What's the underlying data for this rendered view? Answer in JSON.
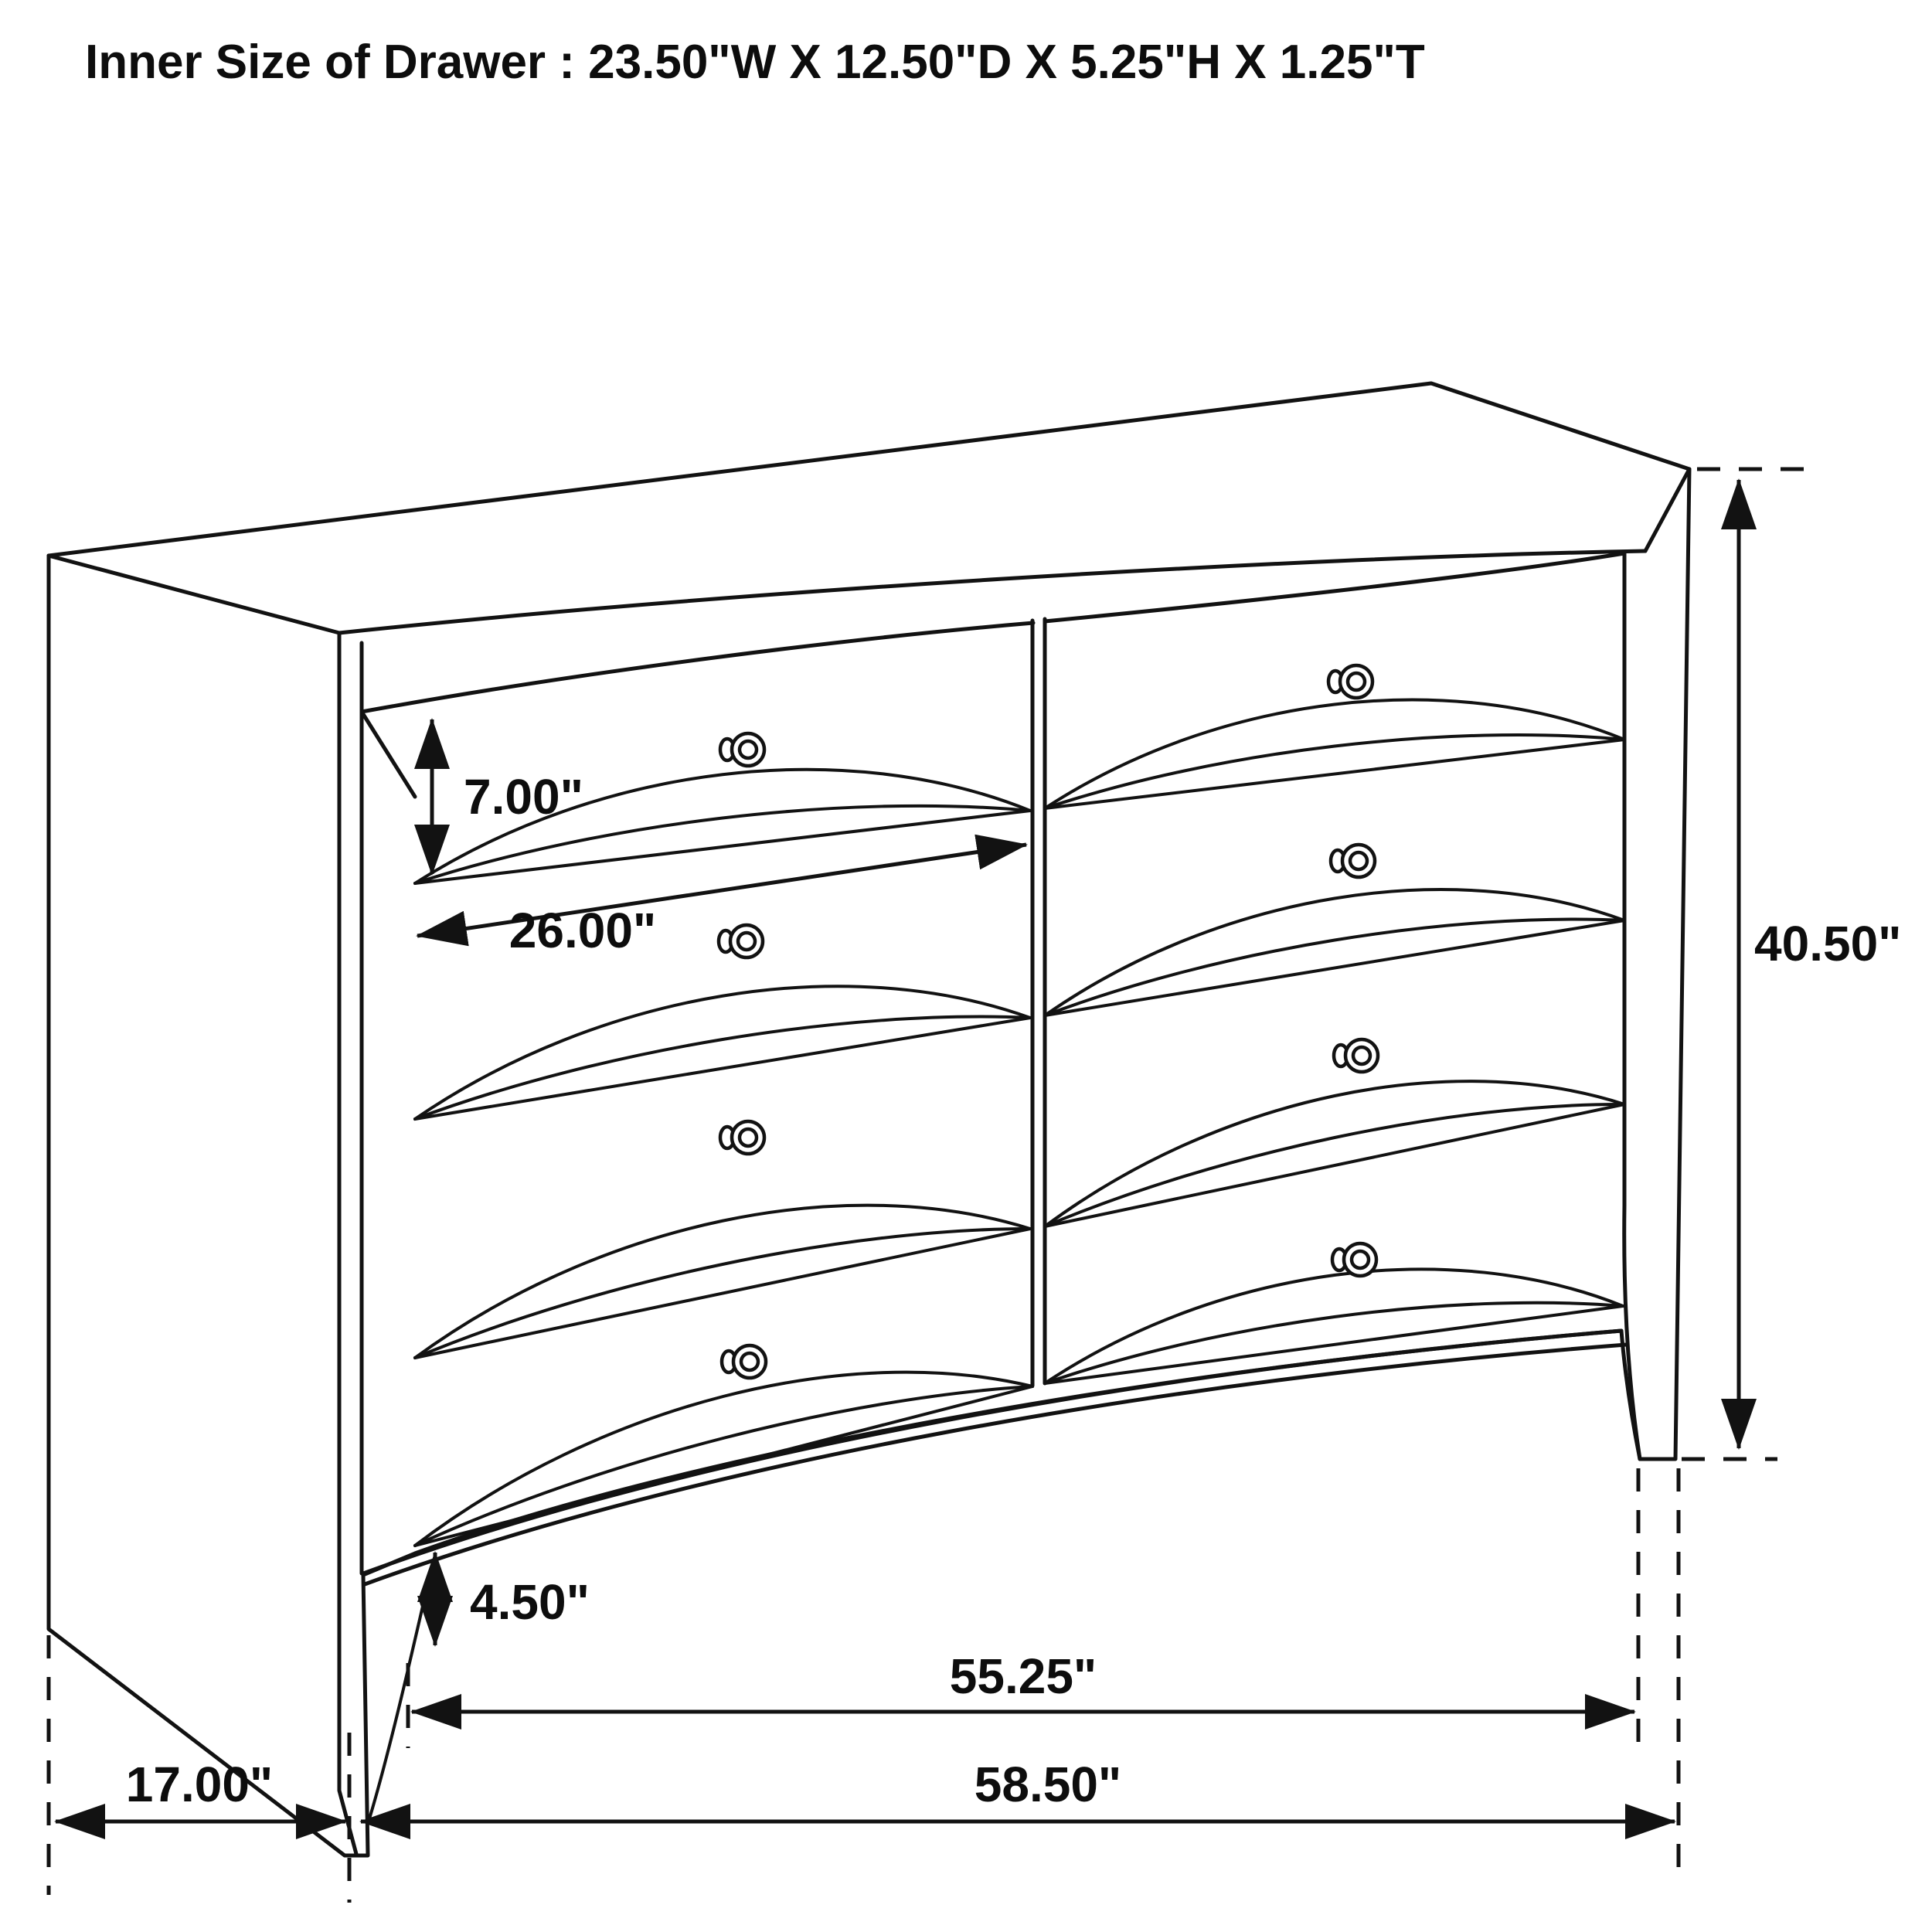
{
  "title": "Inner Size of Drawer : 23.50\"W X 12.50\"D X 5.25\"H X 1.25\"T",
  "figure": {
    "type": "furniture-dimension-diagram",
    "item": "dresser with 8 drawers (2 columns x 4 rows), perspective line drawing",
    "drawer_rows": 4,
    "drawer_columns": 2
  },
  "dimensions": {
    "drawer_front_height": "7.00\"",
    "drawer_front_width": "26.00\"",
    "overall_height": "40.50\"",
    "leg_height": "4.50\"",
    "case_front_width": "55.25\"",
    "side_depth": "17.00\"",
    "overall_width": "58.50\""
  },
  "colors": {
    "line": "#121212",
    "background": "#ffffff"
  }
}
